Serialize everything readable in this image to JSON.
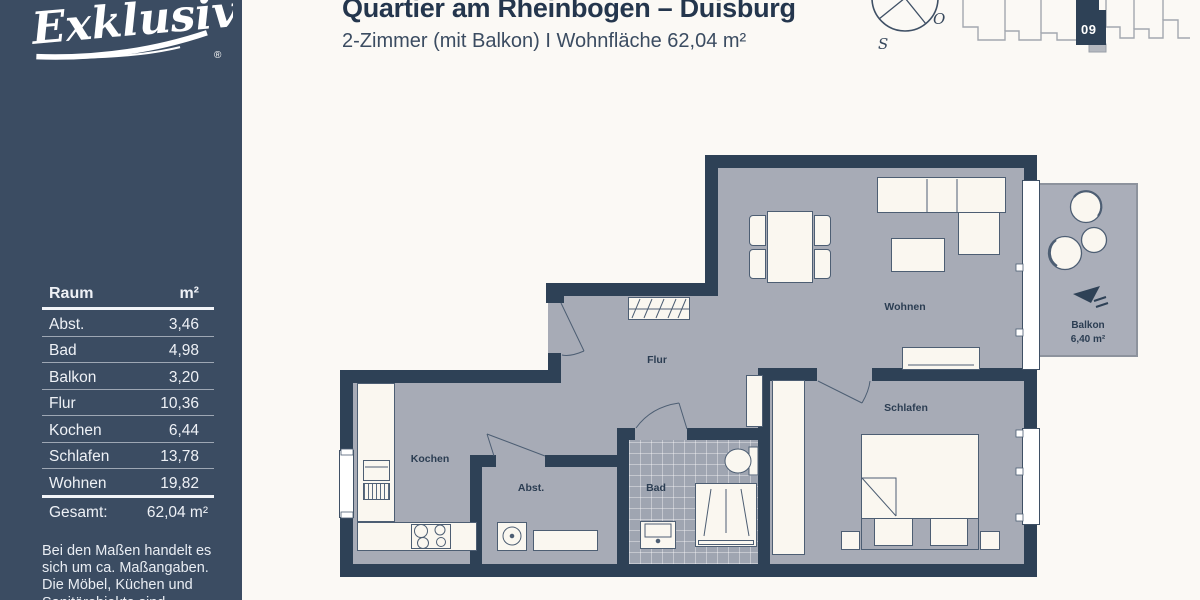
{
  "colors": {
    "sidebar_navy": "#3b4c62",
    "wall_navy": "#2e4156",
    "floor_gray": "#a7abb6",
    "furniture_cream": "#faf7f0",
    "background": "#fbf9f5"
  },
  "sidebar": {
    "brand": "Exklusiv",
    "registered_mark": "®",
    "table": {
      "col_room": "Raum",
      "col_area": "m²",
      "rows": [
        {
          "room": "Abst.",
          "area": "3,46"
        },
        {
          "room": "Bad",
          "area": "4,98"
        },
        {
          "room": "Balkon",
          "area": "3,20"
        },
        {
          "room": "Flur",
          "area": "10,36"
        },
        {
          "room": "Kochen",
          "area": "6,44"
        },
        {
          "room": "Schlafen",
          "area": "13,78"
        },
        {
          "room": "Wohnen",
          "area": "19,82"
        }
      ],
      "total_label": "Gesamt:",
      "total_value": "62,04 m²"
    },
    "disclaimer_lines": [
      "Bei den Maßen handelt es",
      "sich um ca. Maßangaben.",
      "Die Möbel, Küchen und",
      "Sanitärobjekte sind …"
    ]
  },
  "header": {
    "title": "Quartier am Rheinbogen – Duisburg",
    "subtitle": "2-Zimmer (mit Balkon) I Wohnfläche 62,04 m²"
  },
  "compass": {
    "east": "O",
    "south": "S"
  },
  "site_plan": {
    "unit": "09"
  },
  "plan": {
    "rooms": {
      "flur": "Flur",
      "kochen": "Kochen",
      "abstell": "Abst.",
      "bad": "Bad",
      "schlafen": "Schlafen",
      "wohnen": "Wohnen"
    },
    "balcony": {
      "label": "Balkon",
      "area": "6,40 m²"
    }
  }
}
